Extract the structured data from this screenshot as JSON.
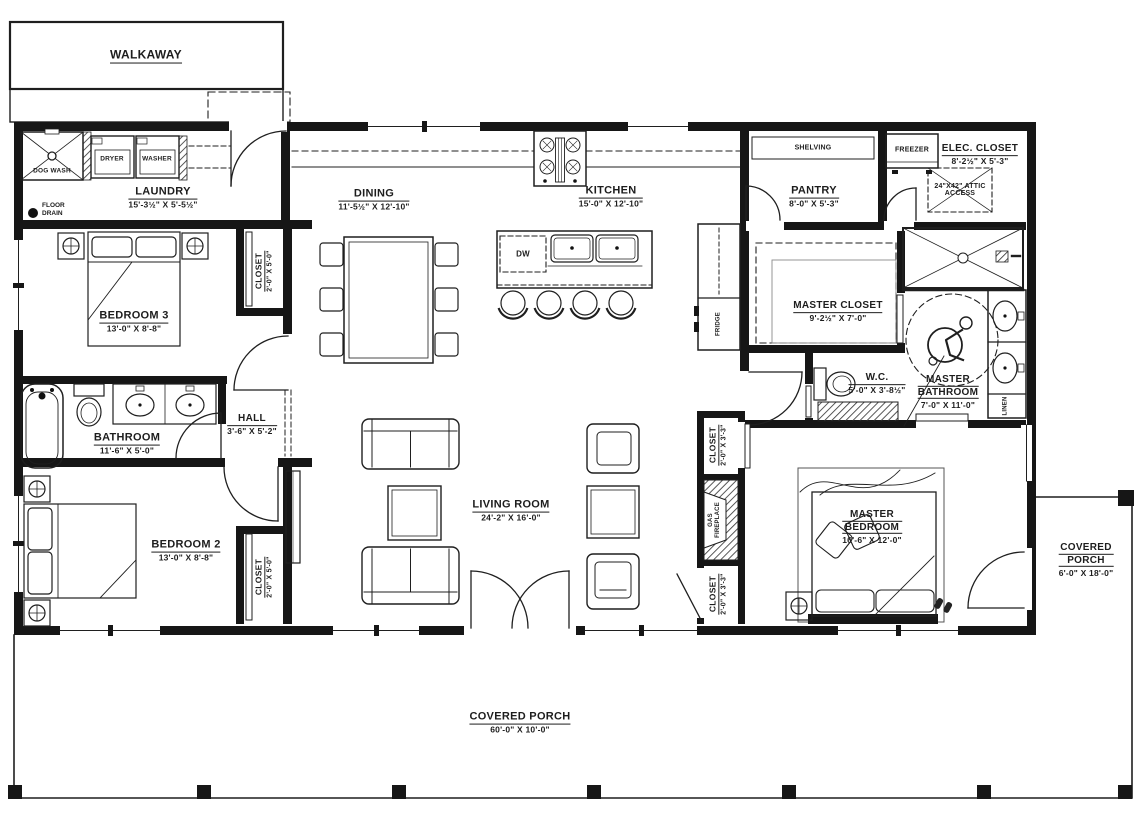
{
  "colors": {
    "wall": "#161616",
    "line": "#1f1f1f",
    "text": "#1d1d1d"
  },
  "labels": {
    "walkaway": "WALKAWAY",
    "dog_wash": "DOG WASH",
    "dryer": "DRYER",
    "washer": "WASHER",
    "dw": "DW",
    "fridge": "FRIDGE",
    "freezer": "FREEZER",
    "shelving": "SHELVING",
    "linen": "LINEN",
    "floor_drain": {
      "line1": "FLOOR",
      "line2": "DRAIN"
    },
    "gas_fireplace": {
      "line1": "GAS",
      "line2": "FIREPLACE"
    },
    "attic": {
      "line1": "24\"X42\" ATTIC",
      "line2": "ACCESS"
    }
  },
  "rooms": {
    "laundry": {
      "name": "LAUNDRY",
      "dims": "15'-3½\" X 5'-5½\""
    },
    "dining": {
      "name": "DINING",
      "dims": "11'-5½\" X 12'-10\""
    },
    "kitchen": {
      "name": "KITCHEN",
      "dims": "15'-0\" X 12'-10\""
    },
    "pantry": {
      "name": "PANTRY",
      "dims": "8'-0\" X 5'-3\""
    },
    "elec_closet": {
      "name": "ELEC. CLOSET",
      "dims": "8'-2½\" X 5'-3\""
    },
    "master_closet": {
      "name": "MASTER CLOSET",
      "dims": "9'-2½\" X 7'-0\""
    },
    "wc": {
      "name": "W.C.",
      "dims": "5'-0\" X 3'-8½\""
    },
    "master_bathroom": {
      "name_1": "MASTER",
      "name_2": "BATHROOM",
      "dims": "7'-0\" X 11'-0\""
    },
    "bedroom3": {
      "name": "BEDROOM 3",
      "dims": "13'-0\" X 8'-8\""
    },
    "closet_bedroom3": {
      "name": "CLOSET",
      "dims": "2'-0\" X 5'-0\""
    },
    "bathroom": {
      "name": "BATHROOM",
      "dims": "11'-6\" X 5'-0\""
    },
    "hall": {
      "name": "HALL",
      "dims": "3'-6\" X 5'-2\""
    },
    "bedroom2": {
      "name": "BEDROOM 2",
      "dims": "13'-0\" X 8'-8\""
    },
    "closet_bedroom2": {
      "name": "CLOSET",
      "dims": "2'-0\" X 5'-0\""
    },
    "living_room": {
      "name": "LIVING ROOM",
      "dims": "24'-2\" X 16'-0\""
    },
    "closet_hall_upper": {
      "name": "CLOSET",
      "dims": "2'-0\" X 3'-3\""
    },
    "closet_hall_lower": {
      "name": "CLOSET",
      "dims": "2'-0\" X 3'-3\""
    },
    "master_bedroom": {
      "name_1": "MASTER",
      "name_2": "BEDROOM",
      "dims": "16'-6\" X 12'-0\""
    },
    "covered_porch_right": {
      "name_1": "COVERED",
      "name_2": "PORCH",
      "dims": "6'-0\" X 18'-0\""
    },
    "covered_porch_bottom": {
      "name": "COVERED PORCH",
      "dims": "60'-0\" X 10'-0\""
    }
  }
}
